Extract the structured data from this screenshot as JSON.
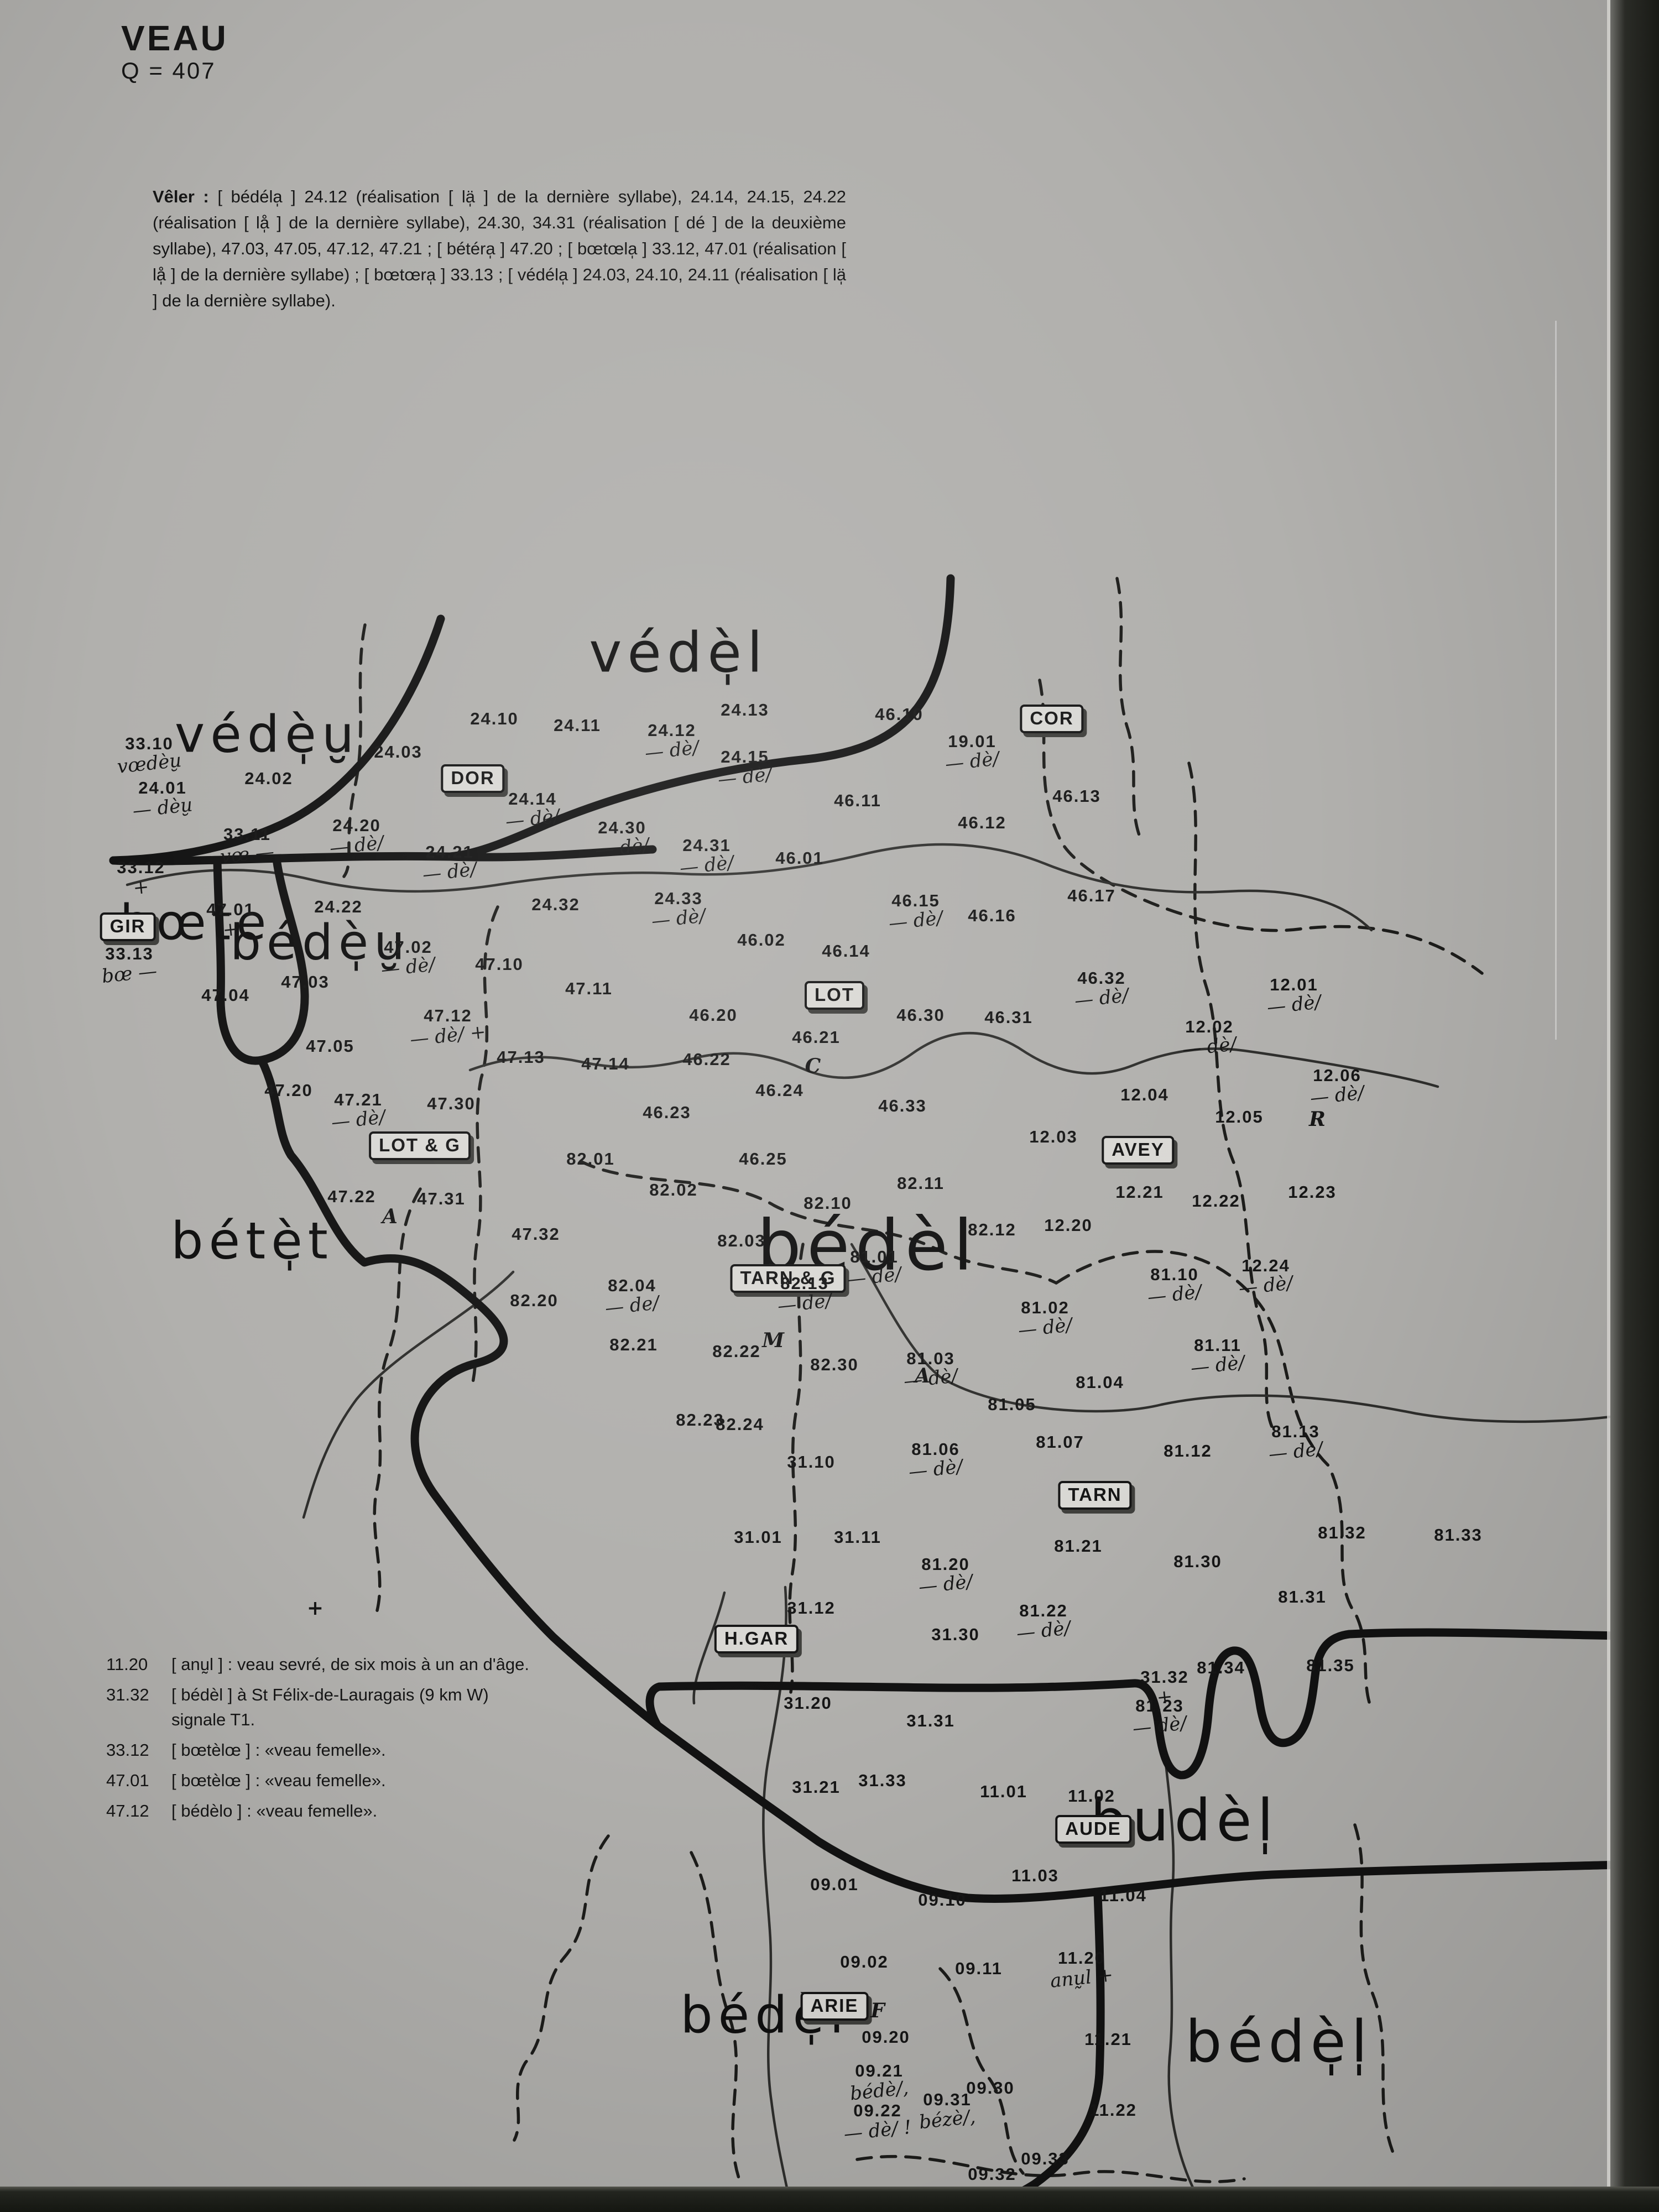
{
  "page": {
    "title": "VEAU",
    "subtitle": "Q = 407"
  },
  "colors": {
    "paper": "#b1b0ad",
    "ink": "#161616",
    "edge_dark": "#1a1b17"
  },
  "intro": {
    "lead": "Vêler :",
    "body": " [ bédéla̩ ] 24.12 (réalisation [ lä̩ ] de la dernière syllabe), 24.14, 24.15, 24.22 (réalisation [ lå̩ ] de la dernière syllabe), 24.30, 34.31 (réalisation [ dé ] de la deuxième syllabe), 47.03, 47.05, 47.12, 47.21 ; [ bétéra̩ ] 47.20 ; [ bœtœla̩ ] 33.12, 47.01 (réalisation [ lå̩ ] de la dernière syllabe) ; [ bœtœra̩ ] 33.13 ; [ védéla̩ ] 24.03, 24.10, 24.11 (réalisation [ lä̩ ] de la dernière syllabe)."
  },
  "legend": [
    {
      "num": "11.20",
      "text": "[ anṵl ] : veau sevré, de six mois à un an d'âge."
    },
    {
      "num": "31.32",
      "text": "[ bédèl ] à St Félix-de-Lauragais (9 km W) signale T1."
    },
    {
      "num": "33.12",
      "text": "[ bœtèlœ ] : «veau femelle»."
    },
    {
      "num": "47.01",
      "text": "[ bœtèlœ ] : «veau femelle»."
    },
    {
      "num": "47.12",
      "text": "[ bédèlo ] : «veau femelle»."
    }
  ],
  "departments": [
    {
      "code": "DOR",
      "x": 28.5,
      "y": 35.2
    },
    {
      "code": "COR",
      "x": 63.4,
      "y": 32.5
    },
    {
      "code": "GIR",
      "x": 7.7,
      "y": 41.9
    },
    {
      "code": "LOT",
      "x": 50.3,
      "y": 45.0
    },
    {
      "code": "AVEY",
      "x": 68.6,
      "y": 52.0
    },
    {
      "code": "LOT & G",
      "x": 25.3,
      "y": 51.8
    },
    {
      "code": "TARN & G",
      "x": 47.5,
      "y": 57.8
    },
    {
      "code": "TARN",
      "x": 66.0,
      "y": 67.6
    },
    {
      "code": "H.GAR",
      "x": 45.6,
      "y": 74.1
    },
    {
      "code": "AUDE",
      "x": 65.9,
      "y": 82.7
    },
    {
      "code": "ARIE",
      "x": 50.3,
      "y": 90.7
    }
  ],
  "area_labels": [
    {
      "text": "védè̩u̮",
      "x": 16.1,
      "y": 33.2,
      "size": 92
    },
    {
      "text": "védè̩l",
      "x": 40.9,
      "y": 29.5,
      "size": 100
    },
    {
      "text": "bœte",
      "x": 11.8,
      "y": 41.7,
      "size": 88
    },
    {
      "text": "bédè̩u̮",
      "x": 19.3,
      "y": 42.6,
      "size": 88
    },
    {
      "text": "bétè̩t",
      "x": 15.2,
      "y": 56.1,
      "size": 92
    },
    {
      "text": "bédèl",
      "x": 52.3,
      "y": 56.3,
      "size": 126
    },
    {
      "text": "budèl̩",
      "x": 71.4,
      "y": 82.3,
      "size": 104
    },
    {
      "text": "bédè̩l",
      "x": 46.1,
      "y": 91.1,
      "size": 92
    },
    {
      "text": "bédè̩l̩",
      "x": 77.1,
      "y": 92.3,
      "size": 104
    }
  ],
  "map_letters": [
    {
      "text": "C",
      "x": 49.0,
      "y": 48.2
    },
    {
      "text": "A",
      "x": 23.5,
      "y": 55.0
    },
    {
      "text": "A",
      "x": 55.6,
      "y": 62.2
    },
    {
      "text": "M",
      "x": 46.6,
      "y": 60.6
    },
    {
      "text": "R",
      "x": 79.4,
      "y": 50.6
    },
    {
      "text": "F",
      "x": 52.9,
      "y": 90.9
    },
    {
      "text": "+",
      "x": 19.0,
      "y": 72.7
    }
  ],
  "points": [
    {
      "id": "33.10",
      "x": 9.0,
      "y": 34.1,
      "sub": "vœdèu̮"
    },
    {
      "id": "24.01",
      "x": 9.8,
      "y": 36.1,
      "sub": "— dèu̮"
    },
    {
      "id": "24.02",
      "x": 16.2,
      "y": 35.2
    },
    {
      "id": "24.03",
      "x": 24.0,
      "y": 34.0
    },
    {
      "id": "24.10",
      "x": 29.8,
      "y": 32.5
    },
    {
      "id": "24.11",
      "x": 34.8,
      "y": 32.8
    },
    {
      "id": "24.12",
      "x": 40.5,
      "y": 33.5,
      "sub": "— dè/"
    },
    {
      "id": "24.13",
      "x": 44.9,
      "y": 32.1
    },
    {
      "id": "24.14",
      "x": 32.1,
      "y": 36.6,
      "sub": "— dè/"
    },
    {
      "id": "24.15",
      "x": 44.9,
      "y": 34.7,
      "sub": "— dè/"
    },
    {
      "id": "24.20",
      "x": 21.5,
      "y": 37.8,
      "sub": "— dè/"
    },
    {
      "id": "24.21",
      "x": 27.1,
      "y": 39.0,
      "sub": "— dè/"
    },
    {
      "id": "24.22",
      "x": 20.4,
      "y": 41.0
    },
    {
      "id": "24.30",
      "x": 37.5,
      "y": 37.9,
      "sub": "— dè/"
    },
    {
      "id": "24.31",
      "x": 42.6,
      "y": 38.7,
      "sub": "— dè/"
    },
    {
      "id": "24.32",
      "x": 33.5,
      "y": 40.9
    },
    {
      "id": "24.33",
      "x": 40.9,
      "y": 41.1,
      "sub": "— dè/"
    },
    {
      "id": "33.11",
      "x": 14.9,
      "y": 38.2,
      "sub": "vœ —"
    },
    {
      "id": "33.12",
      "x": 8.5,
      "y": 39.7,
      "sub": "+"
    },
    {
      "id": "33.13",
      "x": 7.8,
      "y": 43.6,
      "sub": "bœ —"
    },
    {
      "id": "19.01",
      "x": 58.6,
      "y": 34.0,
      "sub": "— dè/"
    },
    {
      "id": "47.01",
      "x": 13.9,
      "y": 41.6,
      "sub": "+"
    },
    {
      "id": "47.02",
      "x": 24.6,
      "y": 43.3,
      "sub": "— dè/"
    },
    {
      "id": "47.03",
      "x": 18.4,
      "y": 44.4
    },
    {
      "id": "47.04",
      "x": 13.6,
      "y": 45.0
    },
    {
      "id": "47.05",
      "x": 19.9,
      "y": 47.3
    },
    {
      "id": "47.10",
      "x": 30.1,
      "y": 43.6
    },
    {
      "id": "47.11",
      "x": 35.5,
      "y": 44.7
    },
    {
      "id": "47.12",
      "x": 27.0,
      "y": 46.4,
      "sub": "— dè/ +"
    },
    {
      "id": "47.13",
      "x": 31.4,
      "y": 47.8
    },
    {
      "id": "47.14",
      "x": 36.5,
      "y": 48.1
    },
    {
      "id": "47.20",
      "x": 17.4,
      "y": 49.3
    },
    {
      "id": "47.21",
      "x": 21.6,
      "y": 50.2,
      "sub": "— dè/"
    },
    {
      "id": "47.22",
      "x": 21.2,
      "y": 54.1
    },
    {
      "id": "47.30",
      "x": 27.2,
      "y": 49.9
    },
    {
      "id": "47.31",
      "x": 26.6,
      "y": 54.2
    },
    {
      "id": "47.32",
      "x": 32.3,
      "y": 55.8
    },
    {
      "id": "46.01",
      "x": 48.2,
      "y": 38.8
    },
    {
      "id": "46.02",
      "x": 45.9,
      "y": 42.5
    },
    {
      "id": "46.10",
      "x": 54.2,
      "y": 32.3
    },
    {
      "id": "46.11",
      "x": 51.7,
      "y": 36.2
    },
    {
      "id": "46.12",
      "x": 59.2,
      "y": 37.2
    },
    {
      "id": "46.13",
      "x": 64.9,
      "y": 36.0
    },
    {
      "id": "46.14",
      "x": 51.0,
      "y": 43.0
    },
    {
      "id": "46.15",
      "x": 55.2,
      "y": 41.2,
      "sub": "— dè/"
    },
    {
      "id": "46.16",
      "x": 59.8,
      "y": 41.4
    },
    {
      "id": "46.17",
      "x": 65.8,
      "y": 40.5
    },
    {
      "id": "46.20",
      "x": 43.0,
      "y": 45.9
    },
    {
      "id": "46.21",
      "x": 49.2,
      "y": 46.9
    },
    {
      "id": "46.22",
      "x": 42.6,
      "y": 47.9
    },
    {
      "id": "46.23",
      "x": 40.2,
      "y": 50.3
    },
    {
      "id": "46.24",
      "x": 47.0,
      "y": 49.3
    },
    {
      "id": "46.25",
      "x": 46.0,
      "y": 52.4
    },
    {
      "id": "46.30",
      "x": 55.5,
      "y": 45.9
    },
    {
      "id": "46.31",
      "x": 60.8,
      "y": 46.0
    },
    {
      "id": "46.32",
      "x": 66.4,
      "y": 44.7,
      "sub": "— dè/"
    },
    {
      "id": "46.33",
      "x": 54.4,
      "y": 50.0
    },
    {
      "id": "12.01",
      "x": 78.0,
      "y": 45.0,
      "sub": "— dè/"
    },
    {
      "id": "12.02",
      "x": 72.9,
      "y": 46.9,
      "sub": "— dè/"
    },
    {
      "id": "12.03",
      "x": 63.5,
      "y": 51.4
    },
    {
      "id": "12.04",
      "x": 69.0,
      "y": 49.5
    },
    {
      "id": "12.05",
      "x": 74.7,
      "y": 50.5
    },
    {
      "id": "12.06",
      "x": 80.6,
      "y": 49.1,
      "sub": "— dè/"
    },
    {
      "id": "12.20",
      "x": 64.4,
      "y": 55.4
    },
    {
      "id": "12.21",
      "x": 68.7,
      "y": 53.9
    },
    {
      "id": "12.22",
      "x": 73.3,
      "y": 54.3
    },
    {
      "id": "12.23",
      "x": 79.1,
      "y": 53.9
    },
    {
      "id": "12.24",
      "x": 76.3,
      "y": 57.7,
      "sub": "— dè/"
    },
    {
      "id": "82.01",
      "x": 35.6,
      "y": 52.4
    },
    {
      "id": "82.02",
      "x": 40.6,
      "y": 53.8
    },
    {
      "id": "82.03",
      "x": 44.7,
      "y": 56.1
    },
    {
      "id": "82.04",
      "x": 38.1,
      "y": 58.6,
      "sub": "— de/"
    },
    {
      "id": "82.10",
      "x": 49.9,
      "y": 54.4
    },
    {
      "id": "82.11",
      "x": 55.5,
      "y": 53.5
    },
    {
      "id": "82.12",
      "x": 59.8,
      "y": 55.6
    },
    {
      "id": "82.13",
      "x": 48.5,
      "y": 58.5,
      "sub": "— de/"
    },
    {
      "id": "82.20",
      "x": 32.2,
      "y": 58.8
    },
    {
      "id": "82.21",
      "x": 38.2,
      "y": 60.8
    },
    {
      "id": "82.22",
      "x": 44.4,
      "y": 61.1
    },
    {
      "id": "82.23",
      "x": 42.2,
      "y": 64.2
    },
    {
      "id": "82.24",
      "x": 44.6,
      "y": 64.4
    },
    {
      "id": "82.30",
      "x": 50.3,
      "y": 61.7
    },
    {
      "id": "81.01",
      "x": 52.7,
      "y": 57.3,
      "sub": "— dè/"
    },
    {
      "id": "81.02",
      "x": 63.0,
      "y": 59.6,
      "sub": "— dè/"
    },
    {
      "id": "81.03",
      "x": 56.1,
      "y": 61.9,
      "sub": "— dè/"
    },
    {
      "id": "81.04",
      "x": 66.3,
      "y": 62.5
    },
    {
      "id": "81.05",
      "x": 61.0,
      "y": 63.5
    },
    {
      "id": "81.06",
      "x": 56.4,
      "y": 66.0,
      "sub": "— dè/"
    },
    {
      "id": "81.07",
      "x": 63.9,
      "y": 65.2
    },
    {
      "id": "81.10",
      "x": 70.8,
      "y": 58.1,
      "sub": "— dè/"
    },
    {
      "id": "81.11",
      "x": 73.4,
      "y": 61.3,
      "sub": "— dè/"
    },
    {
      "id": "81.12",
      "x": 71.6,
      "y": 65.6
    },
    {
      "id": "81.13",
      "x": 78.1,
      "y": 65.2,
      "sub": "— dè/"
    },
    {
      "id": "81.20",
      "x": 57.0,
      "y": 71.2,
      "sub": "— dè/"
    },
    {
      "id": "81.21",
      "x": 65.0,
      "y": 69.9
    },
    {
      "id": "81.22",
      "x": 62.9,
      "y": 73.3,
      "sub": "— dè/"
    },
    {
      "id": "81.23",
      "x": 69.9,
      "y": 77.6,
      "sub": "— dè/"
    },
    {
      "id": "81.30",
      "x": 72.2,
      "y": 70.6
    },
    {
      "id": "81.31",
      "x": 78.5,
      "y": 72.2
    },
    {
      "id": "81.32",
      "x": 80.9,
      "y": 69.3
    },
    {
      "id": "81.33",
      "x": 87.9,
      "y": 69.4
    },
    {
      "id": "81.34",
      "x": 73.6,
      "y": 75.4
    },
    {
      "id": "81.35",
      "x": 80.2,
      "y": 75.3
    },
    {
      "id": "31.01",
      "x": 45.7,
      "y": 69.5
    },
    {
      "id": "31.10",
      "x": 48.9,
      "y": 66.1
    },
    {
      "id": "31.11",
      "x": 51.7,
      "y": 69.5
    },
    {
      "id": "31.12",
      "x": 48.9,
      "y": 72.7
    },
    {
      "id": "31.20",
      "x": 48.7,
      "y": 77.0
    },
    {
      "id": "31.21",
      "x": 49.2,
      "y": 80.8
    },
    {
      "id": "31.30",
      "x": 57.6,
      "y": 73.9
    },
    {
      "id": "31.31",
      "x": 56.1,
      "y": 77.8
    },
    {
      "id": "31.32",
      "x": 70.2,
      "y": 76.3,
      "sub": "+"
    },
    {
      "id": "31.33",
      "x": 53.2,
      "y": 80.5
    },
    {
      "id": "11.01",
      "x": 60.5,
      "y": 81.0
    },
    {
      "id": "11.02",
      "x": 65.8,
      "y": 81.2
    },
    {
      "id": "11.03",
      "x": 62.4,
      "y": 84.8
    },
    {
      "id": "11.04",
      "x": 67.7,
      "y": 85.7
    },
    {
      "id": "11.20",
      "x": 65.2,
      "y": 89.0,
      "sub": "anṵl +"
    },
    {
      "id": "11.21",
      "x": 66.8,
      "y": 92.2
    },
    {
      "id": "11.22",
      "x": 67.1,
      "y": 95.4
    },
    {
      "id": "09.01",
      "x": 50.3,
      "y": 85.2
    },
    {
      "id": "09.02",
      "x": 52.1,
      "y": 88.7
    },
    {
      "id": "09.10",
      "x": 56.8,
      "y": 85.9
    },
    {
      "id": "09.11",
      "x": 59.0,
      "y": 89.0
    },
    {
      "id": "09.20",
      "x": 53.4,
      "y": 92.1
    },
    {
      "id": "09.21",
      "x": 53.0,
      "y": 94.1,
      "sub": "bédè/,"
    },
    {
      "id": "09.22",
      "x": 52.9,
      "y": 95.9,
      "sub": "— dè/ !"
    },
    {
      "id": "09.30",
      "x": 59.7,
      "y": 94.4
    },
    {
      "id": "09.31",
      "x": 57.1,
      "y": 95.4,
      "sub": "bézè/,"
    },
    {
      "id": "09.32",
      "x": 59.8,
      "y": 98.3
    },
    {
      "id": "09.33",
      "x": 63.0,
      "y": 97.6
    }
  ]
}
